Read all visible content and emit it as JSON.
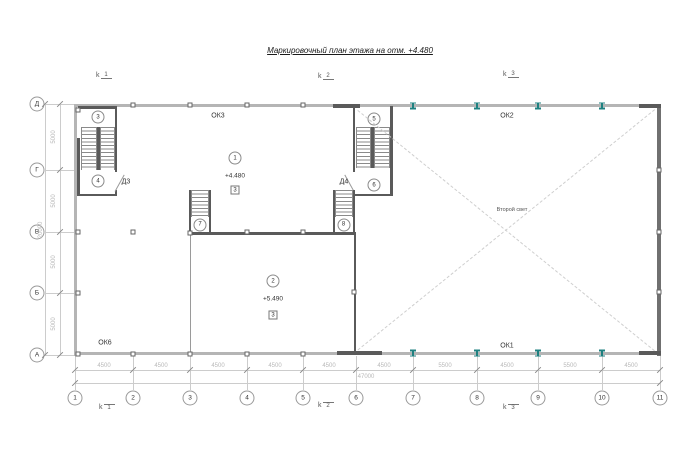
{
  "title": "Маркировочный план этажа на отм. +4.480",
  "section_mark_letter": "k",
  "section_marks_top": [
    "1",
    "2",
    "3"
  ],
  "section_marks_bottom": [
    "1",
    "2",
    "3"
  ],
  "row_axes": [
    "Д",
    "Г",
    "В",
    "Б",
    "А"
  ],
  "col_axes": [
    "1",
    "2",
    "3",
    "4",
    "5",
    "6",
    "7",
    "8",
    "9",
    "10",
    "11"
  ],
  "dims_bottom": [
    "4500",
    "4500",
    "4500",
    "4500",
    "4500",
    "4500",
    "5500",
    "4500",
    "5500",
    "4500"
  ],
  "dim_total_bottom": "47000",
  "dims_left": [
    "5000",
    "5000",
    "5000",
    "5000"
  ],
  "dim_total_left": "20000",
  "labels": {
    "ok3": "ОК3",
    "ok2": "ОК2",
    "ok1": "ОК1",
    "ok6": "ОК6",
    "second_light": "Второй свет",
    "door3": "Д3",
    "door4": "Д4",
    "elev_room1": "+4.480",
    "elev_room2": "+5.490",
    "finish_room1": "3",
    "finish_room2": "3"
  },
  "callouts": [
    "1",
    "2",
    "3",
    "4",
    "5",
    "6",
    "7",
    "8"
  ],
  "colors": {
    "wall_light": "#b5b5b5",
    "wall_dark": "#5a5a5a",
    "steel_column": "#1f8080",
    "dim_text": "#b8b8b8",
    "text": "#333333"
  }
}
